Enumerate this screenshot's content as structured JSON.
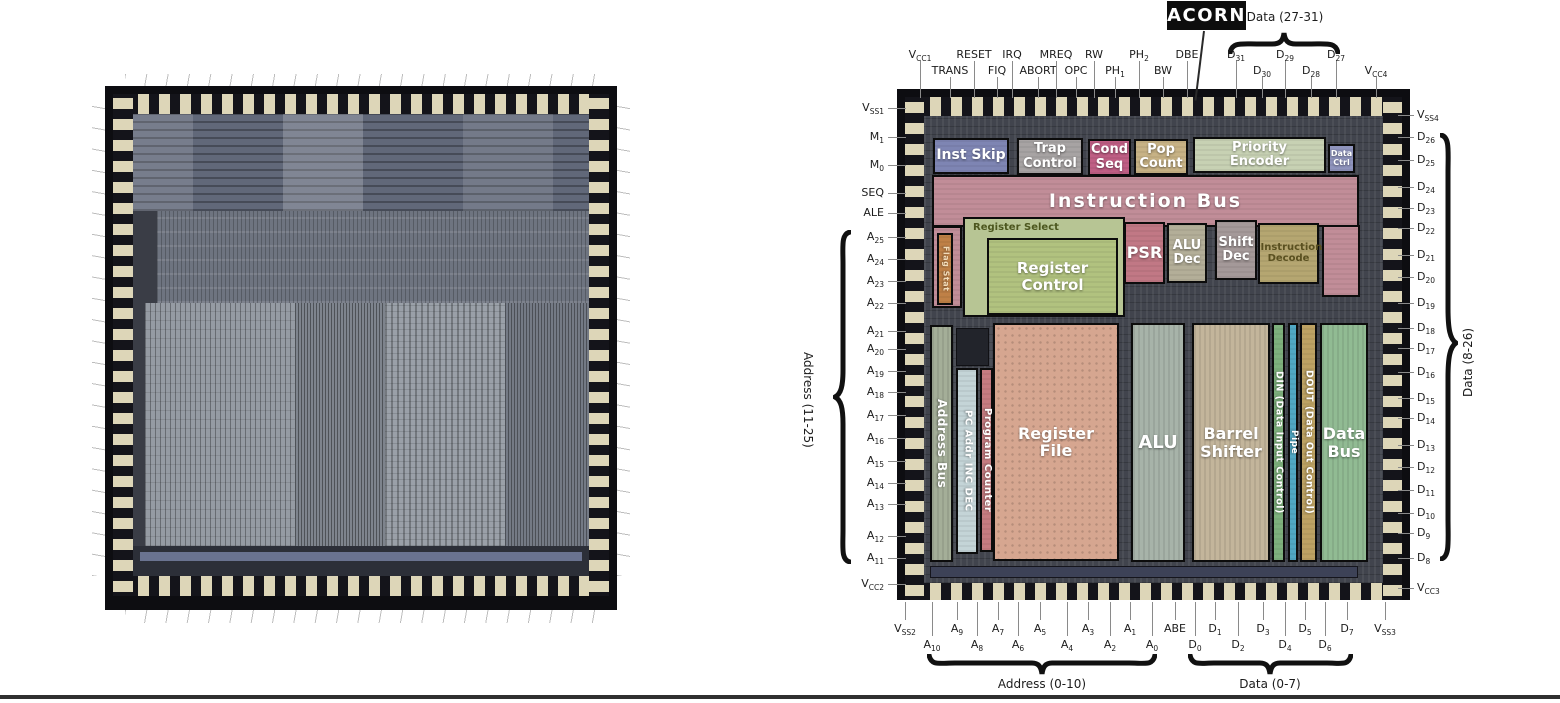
{
  "figure": {
    "acorn_label": "ACORN",
    "braces": {
      "top": "Data (27-31)",
      "left": "Address (11-25)",
      "right": "Data (8-26)",
      "bottom_left": "Address (0-10)",
      "bottom_right": "Data (0-7)"
    },
    "blocks": {
      "inst_skip": "Inst Skip",
      "trap_control": "Trap Control",
      "cond_seq": "Cond Seq",
      "pop_count": "Pop Count",
      "priority_encoder": "Priority Encoder",
      "data_ctrl": "Data Ctrl",
      "instruction_bus": "Instruction Bus",
      "register_select": "Register Select",
      "flag_stat": "Flag Stat",
      "register_control": "Register Control",
      "psr": "PSR",
      "alu_dec": "ALU Dec",
      "shift_dec": "Shift Dec",
      "instruction_decode": "Instruction Decode",
      "address_bus": "Address Bus",
      "pc_addr": "PC Addr INC DEC",
      "program_counter": "Program Counter",
      "register_file": "Register File",
      "alu": "ALU",
      "barrel_shifter": "Barrel Shifter",
      "din": "DIN (Data Input Control)",
      "pipe": "Pipe",
      "dout": "DOUT (Data Out Control)",
      "data_bus": "Data Bus"
    },
    "block_colors": {
      "inst_skip": "#7e85b3",
      "trap_control": "#a7a3a3",
      "cond_seq": "#bf5e84",
      "pop_count": "#c7b285",
      "priority_encoder": "#c7d1b3",
      "data_ctrl": "#8f94bd",
      "instruction_bus": "#c18d98",
      "register_select": "#b7c594",
      "flag_stat": "#bf8046",
      "register_control": "#b1c27f",
      "psr": "#c17885",
      "alu_dec": "#b3ae98",
      "shift_dec": "#a49999",
      "instruction_decode": "#b5a671",
      "address_bus": "#a4ae98",
      "pc_addr": "#c4d4d7",
      "program_counter": "#c57c81",
      "register_file": "#d6a690",
      "alu": "#a7b3a9",
      "barrel_shifter": "#c3b59b",
      "din": "#7eb17d",
      "pipe": "#50a7c3",
      "dout": "#bda263",
      "data_bus": "#91bb93"
    },
    "pins": {
      "top": [
        {
          "b": "V",
          "s": "CC1"
        },
        {
          "b": "TRANS"
        },
        {
          "b": "RESET"
        },
        {
          "b": "FIQ"
        },
        {
          "b": "IRQ"
        },
        {
          "b": "ABORT"
        },
        {
          "b": "MREQ"
        },
        {
          "b": "OPC"
        },
        {
          "b": "RW"
        },
        {
          "b": "PH",
          "s": "1"
        },
        {
          "b": "PH",
          "s": "2"
        },
        {
          "b": "BW"
        },
        {
          "b": "DBE"
        },
        {
          "b": "D",
          "s": "31"
        },
        {
          "b": "D",
          "s": "30"
        },
        {
          "b": "D",
          "s": "29"
        },
        {
          "b": "D",
          "s": "28"
        },
        {
          "b": "D",
          "s": "27"
        },
        {
          "b": "V",
          "s": "CC4"
        }
      ],
      "left": [
        {
          "b": "V",
          "s": "SS1"
        },
        {
          "b": "M",
          "s": "1"
        },
        {
          "b": "M",
          "s": "0"
        },
        {
          "b": "SEQ"
        },
        {
          "b": "ALE"
        },
        {
          "b": "A",
          "s": "25"
        },
        {
          "b": "A",
          "s": "24"
        },
        {
          "b": "A",
          "s": "23"
        },
        {
          "b": "A",
          "s": "22"
        },
        {
          "b": "A",
          "s": "21"
        },
        {
          "b": "A",
          "s": "20"
        },
        {
          "b": "A",
          "s": "19"
        },
        {
          "b": "A",
          "s": "18"
        },
        {
          "b": "A",
          "s": "17"
        },
        {
          "b": "A",
          "s": "16"
        },
        {
          "b": "A",
          "s": "15"
        },
        {
          "b": "A",
          "s": "14"
        },
        {
          "b": "A",
          "s": "13"
        },
        {
          "b": "A",
          "s": "12"
        },
        {
          "b": "A",
          "s": "11"
        },
        {
          "b": "V",
          "s": "CC2"
        }
      ],
      "right": [
        {
          "b": "V",
          "s": "SS4"
        },
        {
          "b": "D",
          "s": "26"
        },
        {
          "b": "D",
          "s": "25"
        },
        {
          "b": "D",
          "s": "24"
        },
        {
          "b": "D",
          "s": "23"
        },
        {
          "b": "D",
          "s": "22"
        },
        {
          "b": "D",
          "s": "21"
        },
        {
          "b": "D",
          "s": "20"
        },
        {
          "b": "D",
          "s": "19"
        },
        {
          "b": "D",
          "s": "18"
        },
        {
          "b": "D",
          "s": "17"
        },
        {
          "b": "D",
          "s": "16"
        },
        {
          "b": "D",
          "s": "15"
        },
        {
          "b": "D",
          "s": "14"
        },
        {
          "b": "D",
          "s": "13"
        },
        {
          "b": "D",
          "s": "12"
        },
        {
          "b": "D",
          "s": "11"
        },
        {
          "b": "D",
          "s": "10"
        },
        {
          "b": "D",
          "s": "9"
        },
        {
          "b": "D",
          "s": "8"
        },
        {
          "b": "V",
          "s": "CC3"
        }
      ],
      "bottom": [
        {
          "b": "V",
          "s": "SS2"
        },
        {
          "b": "A",
          "s": "10"
        },
        {
          "b": "A",
          "s": "9"
        },
        {
          "b": "A",
          "s": "8"
        },
        {
          "b": "A",
          "s": "7"
        },
        {
          "b": "A",
          "s": "6"
        },
        {
          "b": "A",
          "s": "5"
        },
        {
          "b": "A",
          "s": "4"
        },
        {
          "b": "A",
          "s": "3"
        },
        {
          "b": "A",
          "s": "2"
        },
        {
          "b": "A",
          "s": "1"
        },
        {
          "b": "A",
          "s": "0"
        },
        {
          "b": "ABE"
        },
        {
          "b": "D",
          "s": "0"
        },
        {
          "b": "D",
          "s": "1"
        },
        {
          "b": "D",
          "s": "2"
        },
        {
          "b": "D",
          "s": "3"
        },
        {
          "b": "D",
          "s": "4"
        },
        {
          "b": "D",
          "s": "5"
        },
        {
          "b": "D",
          "s": "6"
        },
        {
          "b": "D",
          "s": "7"
        },
        {
          "b": "V",
          "s": "SS3"
        }
      ]
    }
  }
}
